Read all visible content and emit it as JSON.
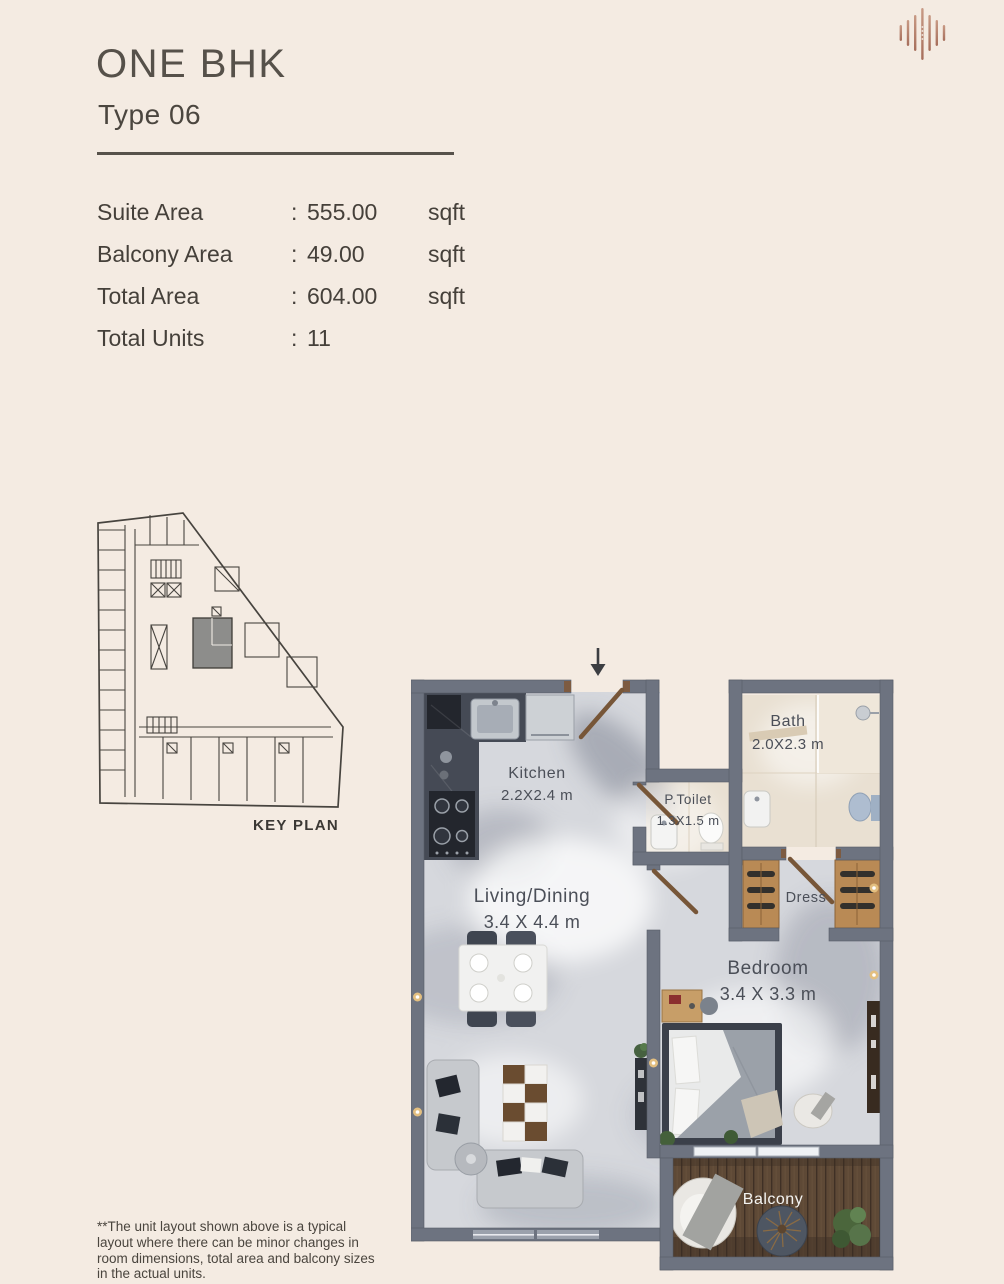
{
  "header": {
    "title": "ONE BHK",
    "subtitle": "Type 06"
  },
  "details": {
    "separator": ":",
    "rows": [
      {
        "label": "Suite Area",
        "value": "555.00",
        "unit": "sqft"
      },
      {
        "label": "Balcony Area",
        "value": "49.00",
        "unit": "sqft"
      },
      {
        "label": "Total Area",
        "value": "604.00",
        "unit": "sqft"
      },
      {
        "label": "Total Units",
        "value": "11",
        "unit": ""
      }
    ]
  },
  "key_plan": {
    "label": "KEY PLAN"
  },
  "floor_plan": {
    "rooms": [
      {
        "name": "Kitchen",
        "dims": "2.2X2.4 m"
      },
      {
        "name": "P.Toilet",
        "dims": "1.3X1.5 m"
      },
      {
        "name": "Bath",
        "dims": "2.0X2.3 m"
      },
      {
        "name": "Dress",
        "dims": ""
      },
      {
        "name": "Living/Dining",
        "dims": "3.4 X 4.4 m"
      },
      {
        "name": "Bedroom",
        "dims": "3.4 X 3.3 m"
      },
      {
        "name": "Balcony",
        "dims": ""
      }
    ]
  },
  "footer": {
    "disclaimer": "**The unit layout shown above is a typical layout where there can be minor changes in room dimensions, total area and balcony sizes in the actual units."
  },
  "colors": {
    "background": "#f4ebe2",
    "ink": "#45403a",
    "wall_gray": "#6d7380",
    "marble_floor": "#d6d8dd",
    "bath_floor": "#e9e0d2",
    "wood": "#b98a55",
    "deck_wood": "#5e4936",
    "logo_copper": "#b5806e",
    "wall_light_gold": "#e3bf80"
  }
}
